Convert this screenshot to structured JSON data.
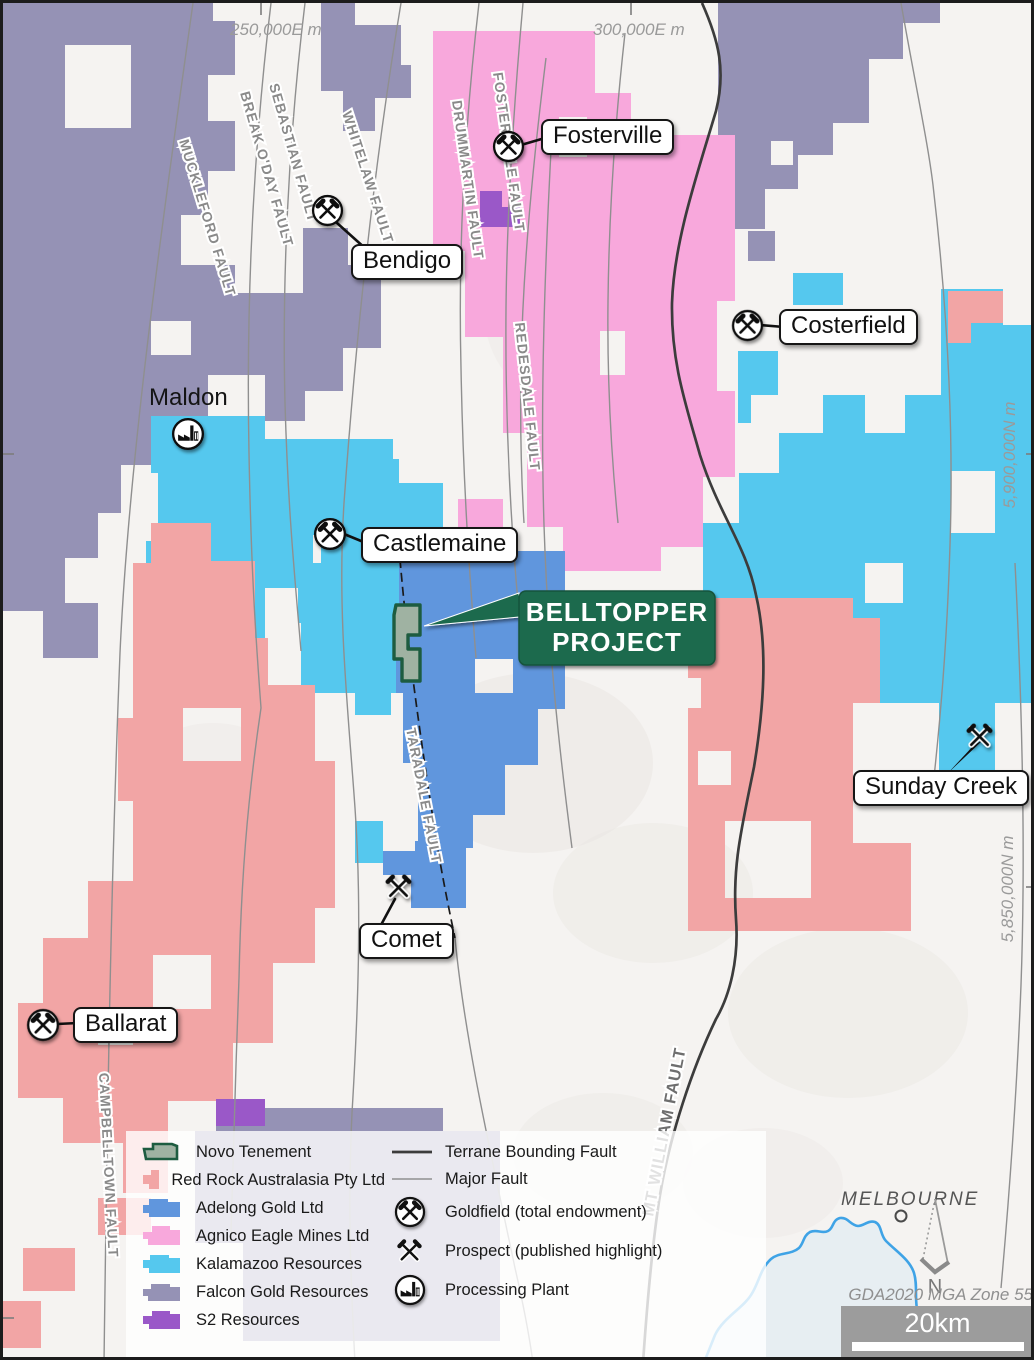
{
  "colors": {
    "red_rock": "#f2a5a5",
    "adelong": "#6096dd",
    "agnico": "#f8a8dc",
    "kalamazoo": "#55c8ee",
    "falcon": "#9592b5",
    "s2": "#9a58c8",
    "novo_fill": "#9fb2a2",
    "novo_stroke": "#1d5c40",
    "belltopper_bg": "#1e6a4e",
    "terrane_fault": "#3c3c3c",
    "major_fault": "#8f8f8f",
    "coast": "#3fa3e6",
    "water": "#e7eef2"
  },
  "grid": {
    "eastings": [
      {
        "label": "250,000E m"
      },
      {
        "label": "300,000E m"
      }
    ],
    "northings": [
      {
        "label": "5,900,000N m"
      },
      {
        "label": "5,850,000N m"
      }
    ]
  },
  "places": {
    "fosterville": {
      "label": "Fosterville"
    },
    "bendigo": {
      "label": "Bendigo"
    },
    "costerfield": {
      "label": "Costerfield"
    },
    "maldon": {
      "label": "Maldon"
    },
    "castlemaine": {
      "label": "Castlemaine"
    },
    "sunday_creek": {
      "label": "Sunday Creek"
    },
    "comet": {
      "label": "Comet"
    },
    "ballarat": {
      "label": "Ballarat"
    },
    "melbourne": {
      "label": "MELBOURNE"
    }
  },
  "project": {
    "line1": "BELLTOPPER",
    "line2": "PROJECT"
  },
  "faults": {
    "muckleford": "MUCKLEFORD FAULT",
    "break_oday": "BREAK O'DAY FAULT",
    "sebastian": "SEBASTIAN FAULT",
    "whitelaw": "WHITELAW FAULT",
    "drummartin": "DRUMMARTIN FAULT",
    "fosterville": "FOSTERVILLE FAULT",
    "redesdale": "REDESDALE FAULT",
    "taradale": "TARADALE FAULT",
    "campbelltown": "CAMPBELLTOWN FAULT",
    "mt_william": "MT WILLIAM FAULT"
  },
  "legend": {
    "items": [
      {
        "label": "Novo Tenement"
      },
      {
        "label": "Red Rock Australasia Pty Ltd"
      },
      {
        "label": "Adelong Gold Ltd"
      },
      {
        "label": "Agnico Eagle Mines Ltd"
      },
      {
        "label": "Kalamazoo Resources"
      },
      {
        "label": "Falcon Gold Resources"
      },
      {
        "label": "S2 Resources"
      }
    ],
    "lines": [
      {
        "label": "Terrane Bounding Fault"
      },
      {
        "label": "Major Fault"
      }
    ],
    "symbols": [
      {
        "label": "Goldfield (total endowment)"
      },
      {
        "label": "Prospect (published highlight)"
      },
      {
        "label": "Processing Plant"
      }
    ]
  },
  "footer": {
    "datum": "GDA2020 MGA Zone 55",
    "scale_label": "20km",
    "north": "N"
  }
}
